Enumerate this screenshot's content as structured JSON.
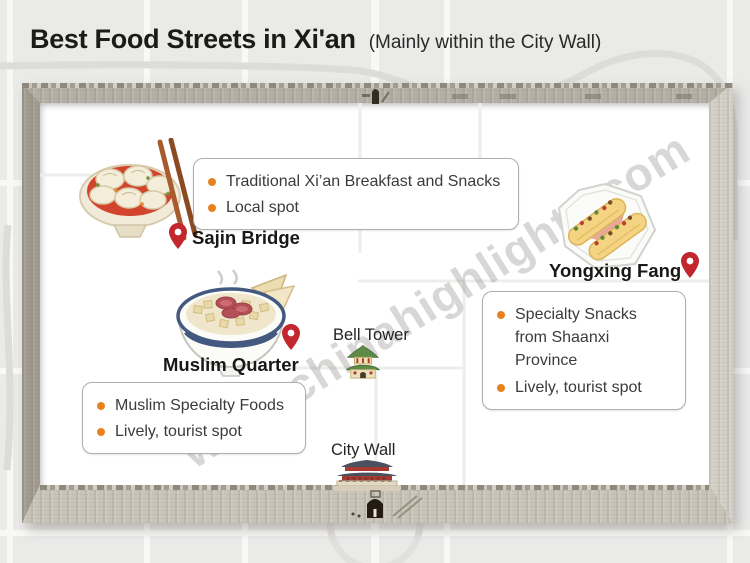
{
  "header": {
    "title": "Best Food Streets in Xi'an",
    "subtitle": "(Mainly within the City Wall)"
  },
  "watermark": "www.chinahighlights.com",
  "locations": {
    "sajin_bridge": {
      "name": "Sajin Bridge",
      "icon": "dumpling-soup-bowl-illustration",
      "notes": [
        "Traditional Xi’an Breakfast and Snacks",
        "Local spot"
      ]
    },
    "muslim_quarter": {
      "name": "Muslim Quarter",
      "icon": "paomo-soup-bowl-illustration",
      "notes": [
        "Muslim Specialty Foods",
        "Lively, tourist spot"
      ]
    },
    "yongxing_fang": {
      "name": "Yongxing Fang",
      "icon": "roujiamo-plate-illustration",
      "notes": [
        "Specialty Snacks from Shaanxi Province",
        "Lively, tourist spot"
      ]
    }
  },
  "landmarks": {
    "bell_tower": {
      "name": "Bell Tower",
      "icon": "bell-tower-illustration"
    },
    "city_wall": {
      "name": "City Wall",
      "icon": "city-gate-illustration"
    }
  },
  "colors": {
    "pin_red": "#c1272d",
    "bullet_orange": "#e8821e",
    "wall_tan": "#b4b0a5",
    "background_gray": "#eaeae9",
    "soup_red": "#d2452c"
  }
}
